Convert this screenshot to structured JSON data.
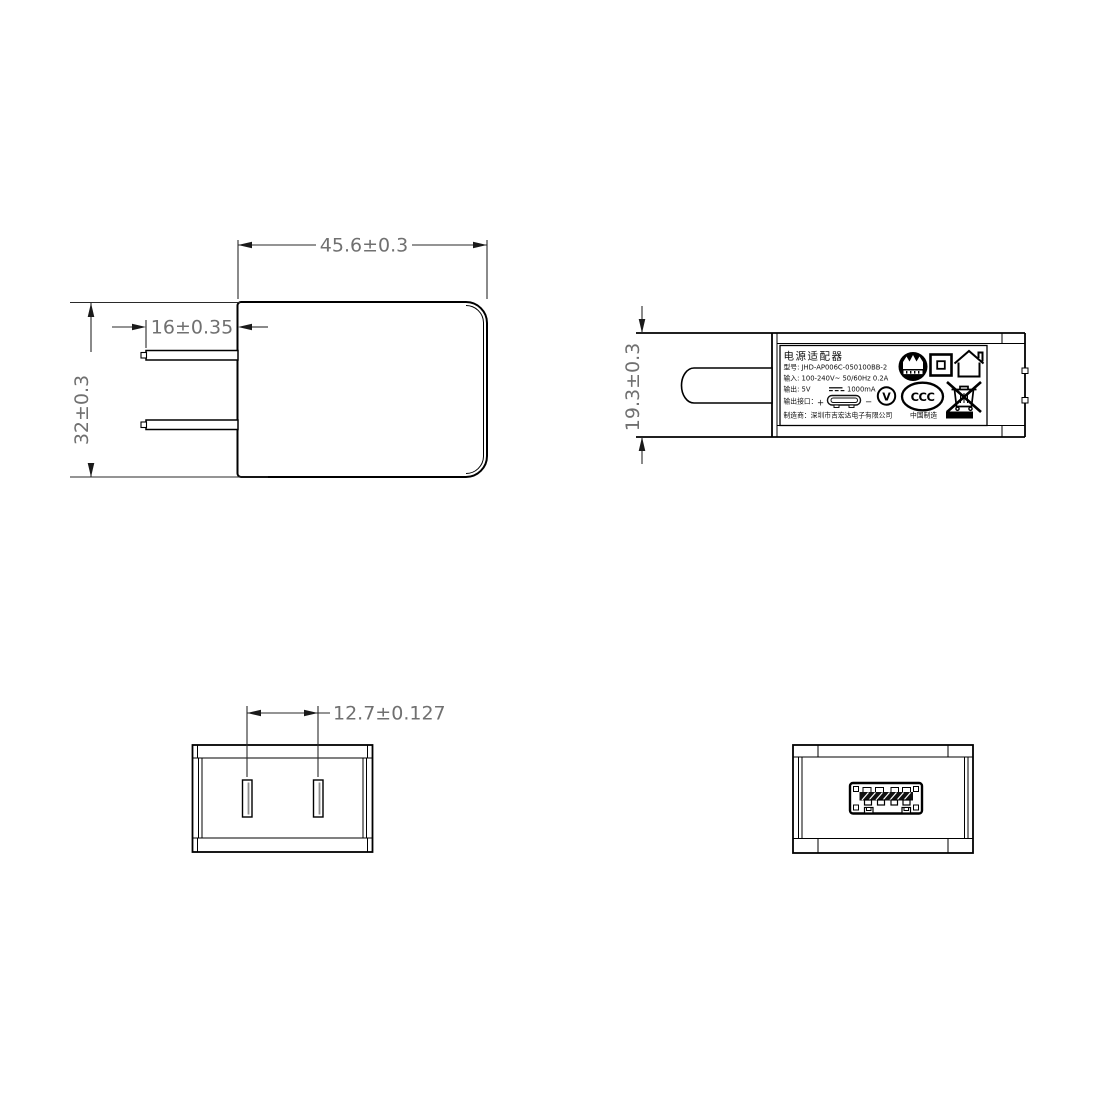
{
  "page": {
    "background": "#ffffff",
    "line_color": "#000000",
    "dim_text_color": "#707070"
  },
  "dimensions": {
    "front_width": "45.6±0.3",
    "front_height": "32±0.3",
    "prong_length": "16±0.35",
    "side_height": "19.3±0.3",
    "pin_spacing": "12.7±0.127"
  },
  "label": {
    "title": "电源适配器",
    "model": "型号: JHD-AP006C-050100BB-2",
    "input": "输入: 100-240V~  50/60Hz  0.2A",
    "output_prefix": "输出: 5V",
    "output_suffix": "1000mA",
    "port_prefix": "输出接口：",
    "plus": "+",
    "minus": "−",
    "manufacturer": "制造商：深圳市吉宏达电子有限公司",
    "made_in": "中国制造",
    "v_text": "V",
    "ccc_text": "CCC"
  },
  "icons": {
    "cert_mark_icon": "black circle certification mark with crown pattern",
    "class_ii_icon": "square-in-square Class II double insulation",
    "indoor_use_icon": "house indoor use only",
    "efficiency_v_icon": "circled V efficiency mark",
    "ccc_icon": "CCC China Compulsory Certification oval",
    "weee_bin_icon": "crossed-out wheelie bin",
    "dc_symbol_icon": "solid line over dashed line DC symbol",
    "usb_connector_icon": "USB connector pill outline",
    "usb_port_icon": "USB-A receptacle end view"
  }
}
